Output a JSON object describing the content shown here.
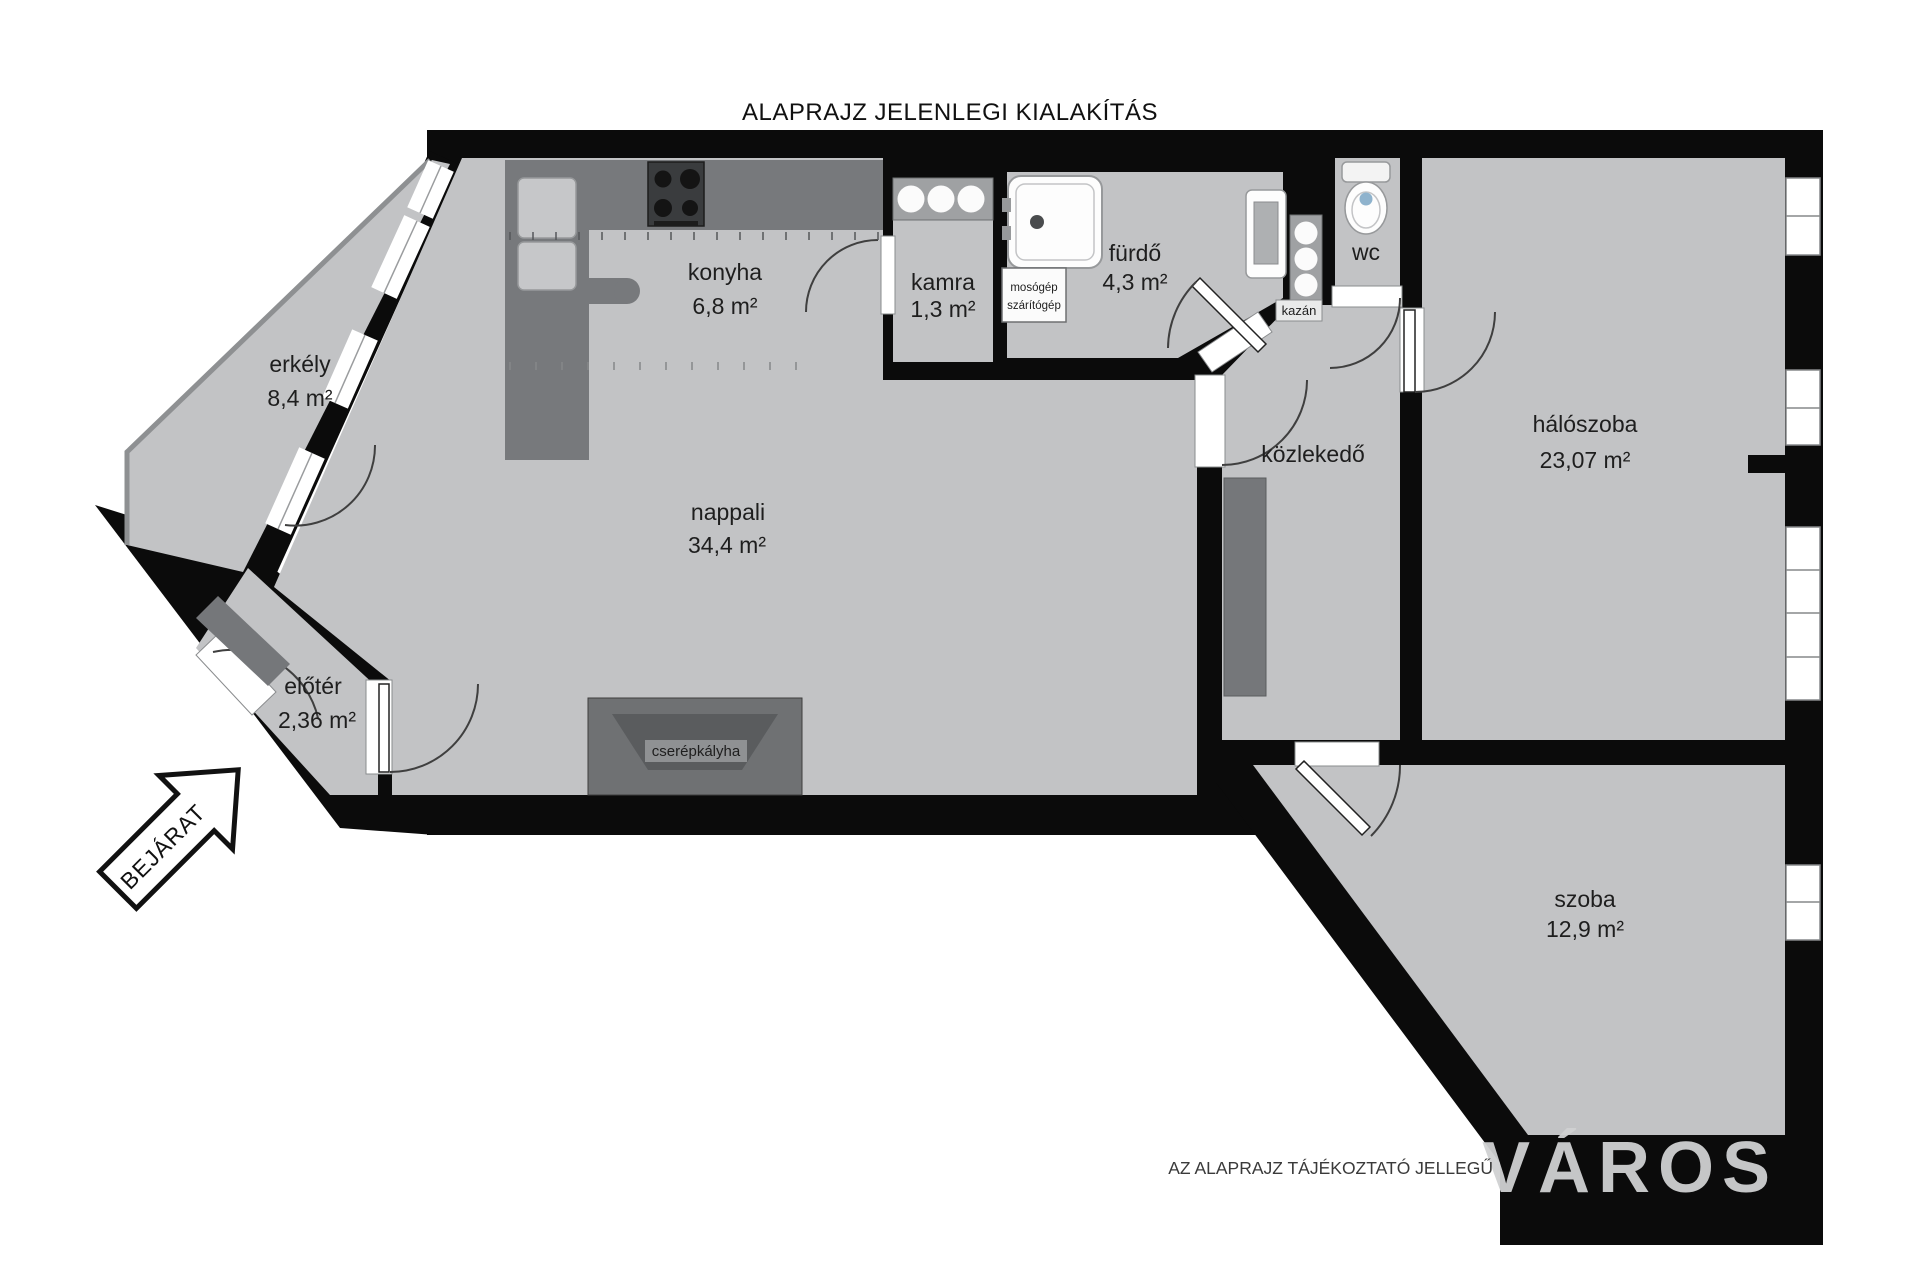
{
  "page": {
    "title": "ALAPRAJZ JELENLEGI KIALAKÍTÁS",
    "disclaimer": "AZ ALAPRAJZ TÁJÉKOZTATÓ JELLEGŰ",
    "watermark": "VÁROS",
    "entrance_label": "BEJÁRAT"
  },
  "rooms": [
    {
      "id": "erkely",
      "name": "erkély",
      "area": "8,4 m²"
    },
    {
      "id": "konyha",
      "name": "konyha",
      "area": "6,8 m²"
    },
    {
      "id": "kamra",
      "name": "kamra",
      "area": "1,3 m²"
    },
    {
      "id": "furdo",
      "name": "fürdő",
      "area": "4,3 m²"
    },
    {
      "id": "wc",
      "name": "wc",
      "area": ""
    },
    {
      "id": "kozlekedo",
      "name": "közlekedő",
      "area": ""
    },
    {
      "id": "haloszoba",
      "name": "hálószoba",
      "area": "23,07 m²"
    },
    {
      "id": "nappali",
      "name": "nappali",
      "area": "34,4 m²"
    },
    {
      "id": "eloter",
      "name": "előtér",
      "area": "2,36 m²"
    },
    {
      "id": "szoba",
      "name": "szoba",
      "area": "12,9 m²"
    }
  ],
  "fixtures": {
    "washer_line1": "mosógép",
    "washer_line2": "szárítógép",
    "boiler": "kazán",
    "tile_stove": "cserépkályha"
  },
  "colors": {
    "wall": "#0b0b0b",
    "floor": "#c2c3c5",
    "furniture_dark": "#75777a",
    "counter_dark": "#77797c",
    "background": "#ffffff",
    "watermark_gray": "#d0d1d2"
  }
}
